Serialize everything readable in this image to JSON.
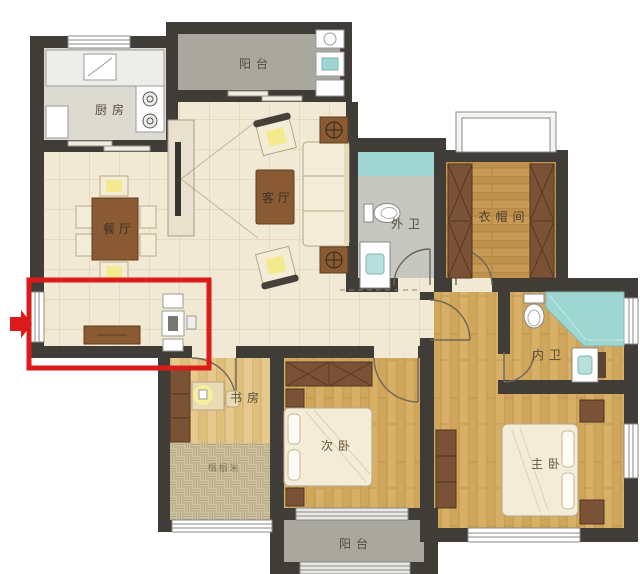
{
  "rooms": [
    {
      "id": "kitchen",
      "label": "厨房"
    },
    {
      "id": "balcony_top",
      "label": "阳台"
    },
    {
      "id": "living_room",
      "label": "客厅"
    },
    {
      "id": "dining_room",
      "label": "餐厅"
    },
    {
      "id": "bath_outer",
      "label": "外卫"
    },
    {
      "id": "cloakroom",
      "label": "衣帽间"
    },
    {
      "id": "bath_inner",
      "label": "内卫"
    },
    {
      "id": "master_bedroom",
      "label": "主卧"
    },
    {
      "id": "second_bedroom",
      "label": "次卧"
    },
    {
      "id": "study",
      "label": "书房"
    },
    {
      "id": "balcony_bottom",
      "label": "阳台"
    },
    {
      "id": "tatami_area",
      "label": "榻榻米"
    }
  ],
  "annotation": {
    "type": "highlight-rectangle-with-arrow",
    "highlight_color": "#dd1a1a"
  },
  "colors": {
    "wall": "#403c38",
    "floor_tile": "#f1e9d3",
    "floor_wood": "#d8af66",
    "floor_wood_light": "#e6c98c",
    "floor_gray": "#c7c7c1",
    "balcony_gray": "#a8a89f",
    "shower_teal": "#9ed6d2",
    "furniture_brown": "#8a5a33",
    "wardrobe_brown": "#7a5236",
    "bed_cream": "#f3ecd8",
    "cushion_yellow": "#f3e98f"
  }
}
